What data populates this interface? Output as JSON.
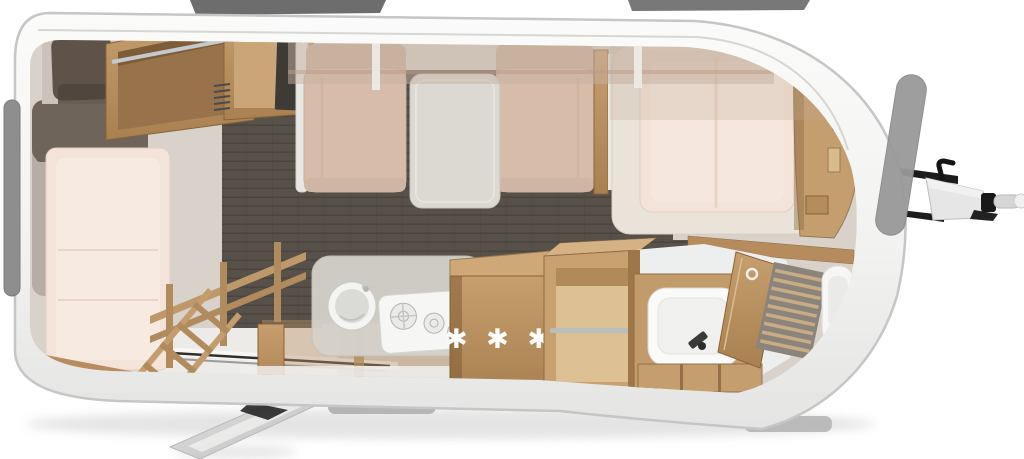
{
  "fridge": {
    "rating_label": "✱ ✱ ✱"
  },
  "colors": {
    "shell": "#f4f4f3",
    "shell_edge": "#c6c6c6",
    "interior": "#d8d2cb",
    "floor": "#58514a",
    "floor_line": "#4b453f",
    "wood": "#bb9266",
    "wood_dark": "#8a6238",
    "wood_light": "#d6b88c",
    "wood_interior": "#97724a",
    "mattress": "#f3e3d9",
    "mattress_light": "#f7eae1",
    "cushion": "#d7bda9",
    "cushion_dark": "#cbb09c",
    "pillow_brown": "#5f5349",
    "blanket_gray": "#6e6459",
    "table": "#dbd9d2",
    "counter": "#d5d2cb",
    "fixture": "#f8f8f7",
    "basin": "#fafaf9",
    "window_dark": "#6d6d6d",
    "window_gray": "#8e8e8e",
    "glass_gray": "#999999",
    "hitch_dark": "#1c1c1c",
    "hitch_gray": "#e6e6e6",
    "step_gray": "#b5b5b5",
    "overlay_tan": "#c6b2a1",
    "bath_floor": "#edefee",
    "white_floor": "#edebe7"
  }
}
